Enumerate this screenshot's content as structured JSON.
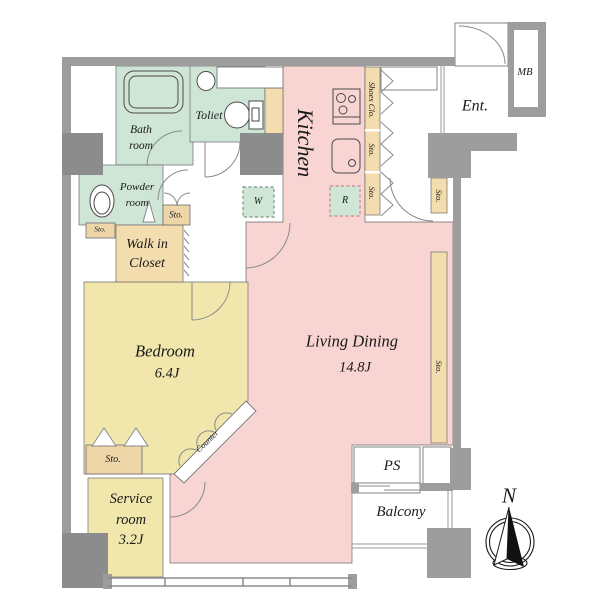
{
  "colors": {
    "wall": "#9d9d9d",
    "pillar": "#8c8c8c",
    "pink": "#f8d5d2",
    "green": "#cfe6d7",
    "yellow": "#f1e6ac",
    "tan": "#f3ddae",
    "tan_dark": "#efd6a9",
    "line": "#6b6b6b",
    "text": "#1a1a1a"
  },
  "rooms": {
    "bath": "Bath\nroom",
    "toilet": "Toliet",
    "kitchen": "Kitchen",
    "powder": "Powder\nroom",
    "walk_in_closet": "Walk in\nCloset",
    "bedroom": "Bedroom",
    "bedroom_area": "6.4J",
    "living_dining": "Living Dining",
    "living_dining_area": "14.8J",
    "service_room": "Service\nroom\n3.2J",
    "entrance": "Ent.",
    "meter_box": "MB",
    "pipe_space": "PS",
    "balcony": "Balcony"
  },
  "fixtures": {
    "shoes_closet": "Shoes Clo.",
    "storage": "Sto.",
    "washer": "W",
    "refrigerator": "R",
    "counter": "Counter"
  },
  "compass": {
    "north": "N"
  }
}
